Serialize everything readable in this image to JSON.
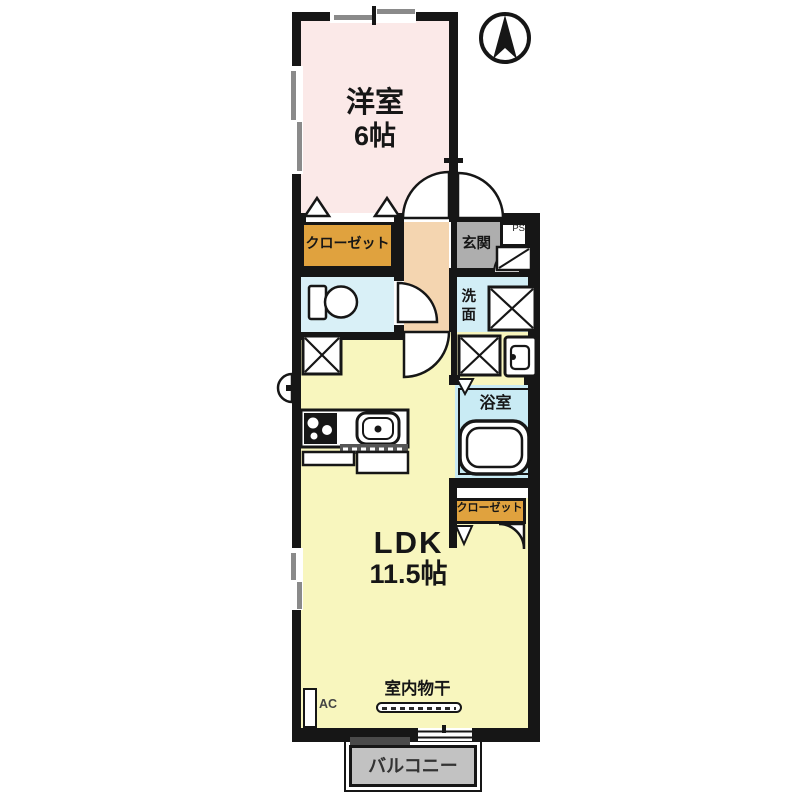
{
  "labels": {
    "western_room": "洋室",
    "western_room_size": "6帖",
    "closet_upper": "クローゼット",
    "closet_lower": "クローゼット",
    "entrance": "玄関",
    "pipe_space": "PS",
    "washroom": "洗面",
    "bathroom": "浴室",
    "ldk": "LDK",
    "ldk_size": "11.5帖",
    "indoor_drying": "室内物干",
    "ac_unit": "AC",
    "balcony": "バルコニー"
  },
  "colors": {
    "wall": "#161616",
    "western_room": "#fbe9e8",
    "hallway": "#f4d5b0",
    "closet": "#e0a23e",
    "entrance": "#aeaeae",
    "toilet": "#d9f0f7",
    "washroom": "#d2eef6",
    "bathroom": "#c9ebf4",
    "ldk": "#f8f6be",
    "balcony": "#c2c2c2"
  }
}
